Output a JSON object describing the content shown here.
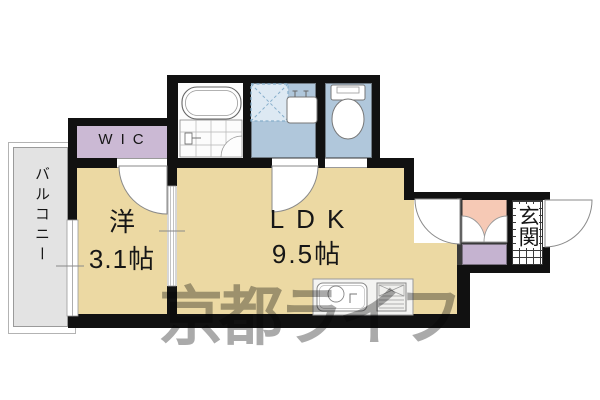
{
  "floorplan": {
    "rooms": {
      "balcony": {
        "label": "バルコニー"
      },
      "wic": {
        "label": "WIC"
      },
      "western": {
        "label": "洋",
        "size": "3.1帖"
      },
      "ldk": {
        "label": "LDK",
        "size": "9.5帖"
      },
      "genkan": {
        "label": "玄関"
      }
    },
    "fixtures": [
      "bathtub",
      "bath-tile-floor",
      "washing-machine-space",
      "washbasin",
      "toilet",
      "kitchen-sink",
      "gas-stove",
      "bifold-closet-doors",
      "storage",
      "front-door-arc",
      "balcony-window",
      "sliding-door"
    ],
    "colors": {
      "room_tan": "#ecd9a3",
      "wic_lavender": "#cbb9d4",
      "storage_lavender": "#c5b3d0",
      "sanitary_blue": "#b0c7db",
      "closet_pink": "#f6c9b5",
      "balcony_gray": "#e3e3e3",
      "wall_black": "#111111",
      "watermark_gray": "#aaaaaa"
    },
    "watermark": {
      "text": "京都ライフ"
    }
  }
}
